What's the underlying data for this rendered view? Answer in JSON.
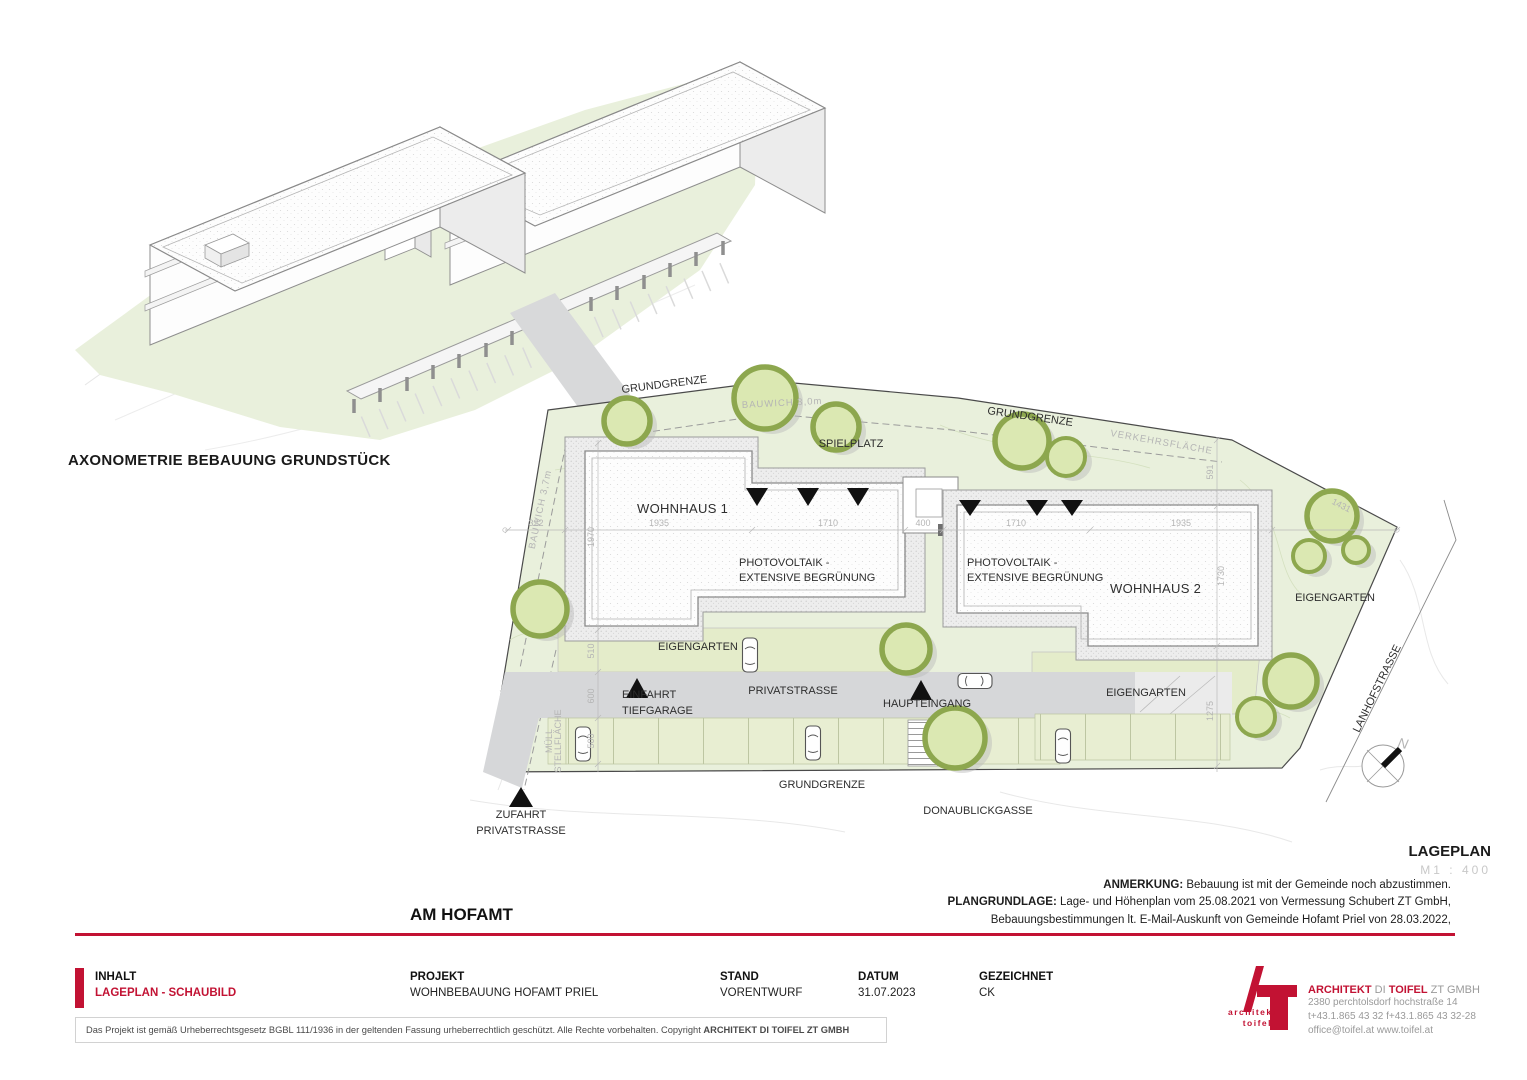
{
  "colors": {
    "accent_red": "#c21233",
    "site_green": "#e9f0dc",
    "tree_outline": "#8da74e",
    "street_gray": "#d6d7d9"
  },
  "axonometric": {
    "caption": "AXONOMETRIE BEBAUUNG GRUNDSTÜCK"
  },
  "plan": {
    "labels": {
      "grundgrenze": "GRUNDGRENZE",
      "verkehrsflaeche": "VERKEHRSFLÄCHE",
      "bauwich_top": "BAUWICH 3,0m",
      "bauwich_left": "BAUWICH 3,7m",
      "spielplatz": "SPIELPLATZ",
      "wohnhaus1": "WOHNHAUS 1",
      "wohnhaus2": "WOHNHAUS 2",
      "pv_line1": "PHOTOVOLTAIK -",
      "pv_line2": "EXTENSIVE BEGRÜNUNG",
      "eigengarten": "EIGENGARTEN",
      "einfahrt_line1": "EINFAHRT",
      "einfahrt_line2": "TIEFGARAGE",
      "privatstrasse": "PRIVATSTRASSE",
      "haupteingang": "HAUPTEINGANG",
      "muell_line1": "MÜLL",
      "muell_line2": "STELLFLÄCHE",
      "zufahrt_line1": "ZUFAHRT",
      "zufahrt_line2": "PRIVATSTRASSE",
      "donaublickgasse": "DONAUBLICKGASSE",
      "lanhofstrasse": "LANHOFSTRASSE",
      "north": "N"
    },
    "dimensions": {
      "d322": "322",
      "d1970": "1970",
      "d1935": "1935",
      "d1710": "1710",
      "d400": "400",
      "d591": "591",
      "d1730": "1730",
      "d510": "510",
      "d600": "600",
      "d500": "500",
      "d1275": "1275",
      "d1431": "1431"
    }
  },
  "legend": {
    "title": "LAGEPLAN",
    "scale": "M1 : 400"
  },
  "notes": {
    "anmerkung_label": "ANMERKUNG:",
    "anmerkung_text": " Bebauung ist mit der Gemeinde noch abzustimmen.",
    "plangrundlage_label": "PLANGRUNDLAGE:",
    "plangrundlage_text": " Lage- und Höhenplan vom 25.08.2021 von Vermessung Schubert ZT GmbH,",
    "plangrundlage_text2": "Bebauungsbestimmungen lt. E-Mail-Auskunft von Gemeinde Hofamt Priel von 28.03.2022,"
  },
  "project_title": "AM HOFAMT",
  "title_block": {
    "inhalt_label": "INHALT",
    "inhalt_value": "LAGEPLAN - SCHAUBILD",
    "projekt_label": "PROJEKT",
    "projekt_value": "WOHNBEBAUUNG HOFAMT PRIEL",
    "stand_label": "STAND",
    "stand_value": "VORENTWURF",
    "datum_label": "DATUM",
    "datum_value": "31.07.2023",
    "gezeichnet_label": "GEZEICHNET",
    "gezeichnet_value": "CK"
  },
  "copyright": {
    "text": "Das Projekt ist gemäß Urheberrechtsgesetz BGBL 111/1936 in der geltenden Fassung urheberrechtlich geschützt. Alle Rechte vorbehalten. Copyright ",
    "bold": "ARCHITEKT DI TOIFEL ZT GMBH"
  },
  "architect": {
    "logo_text1": "architekt",
    "logo_text2": "toifel",
    "name_part1": "ARCHITEKT",
    "name_part2": " DI ",
    "name_part3": "TOIFEL",
    "name_part4": " ZT GMBH",
    "address": "2380 perchtolsdorf hochstraße 14",
    "phone": "t+43.1.865 43 32  f+43.1.865 43 32-28",
    "web": "office@toifel.at  www.toifel.at"
  }
}
